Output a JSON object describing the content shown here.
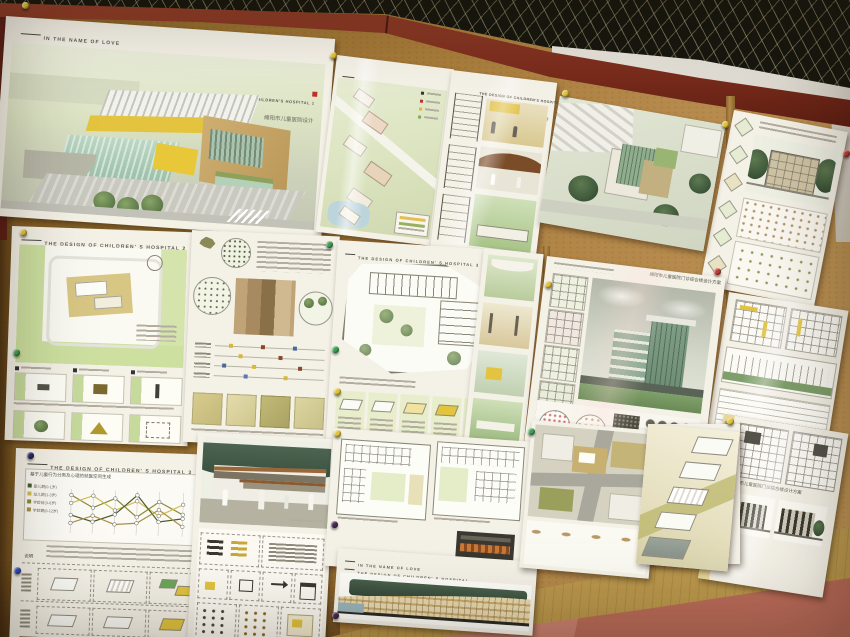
{
  "colors": {
    "cork": "#a87c3a",
    "beam_red": "#7a2c1c",
    "ceiling_black": "#17170f",
    "ceiling_white": "#e9e6de",
    "ledge_tan": "#c4a65e",
    "floor_tile_dark": "#9e5244",
    "floor_tile_light": "#c7806e",
    "poster_paper": "#f4f1e7",
    "site_plan_green": "#d9e2bc",
    "accent_yellow": "#e4c43e",
    "glass_green": "#9cc0a8",
    "pin_yellow": "#e0c23a",
    "pin_green": "#3f9e52",
    "pin_blue": "#2f4fc0",
    "pin_red": "#c23a2e"
  },
  "posters": {
    "p1": {
      "motto": "IN THE NAME OF LOVE",
      "title_en": "THE DESIGN OF CHILDREN'S HOSPITAL 1",
      "subtitle_cn": "绵阳市儿童医院设计"
    },
    "p2": {
      "motto": "IN THE NAME OF LOVE"
    },
    "p3": {
      "title_en": "THE DESIGN OF CHILDREN'S HOSPITAL 1",
      "subtitle_cn": "绵阳市儿童医院设计"
    },
    "p6": {
      "title_en": "THE DESIGN OF CHILDREN' S HOSPITAL 2"
    },
    "p8": {
      "title_en": "THE DESIGN OF CHILDREN' S HOSPITAL 3"
    },
    "p9": {
      "title_cn": "绵阳市儿童医院门诊综合楼设计方案"
    },
    "p11": {
      "title_en": "THE DESIGN OF CHILDREN' S HOSPITAL 3",
      "chart_title_cn": "基于儿童行为分类及心理的就医空间生成",
      "note_label_cn": "说明",
      "age_groups": [
        "婴儿期(0-1岁)",
        "幼儿期(1-3岁)",
        "学龄前(3-6岁)",
        "学龄期(6-12岁)"
      ]
    },
    "p13": {
      "motto": "IN THE NAME OF LOVE",
      "title_en": "THE DESIGN OF CHILDREN' S HOSPITAL"
    },
    "p16": {
      "title_cn": "绵阳市儿童医院门诊综合楼设计方案",
      "side_cn": "绵阳市儿童医院设计"
    }
  }
}
